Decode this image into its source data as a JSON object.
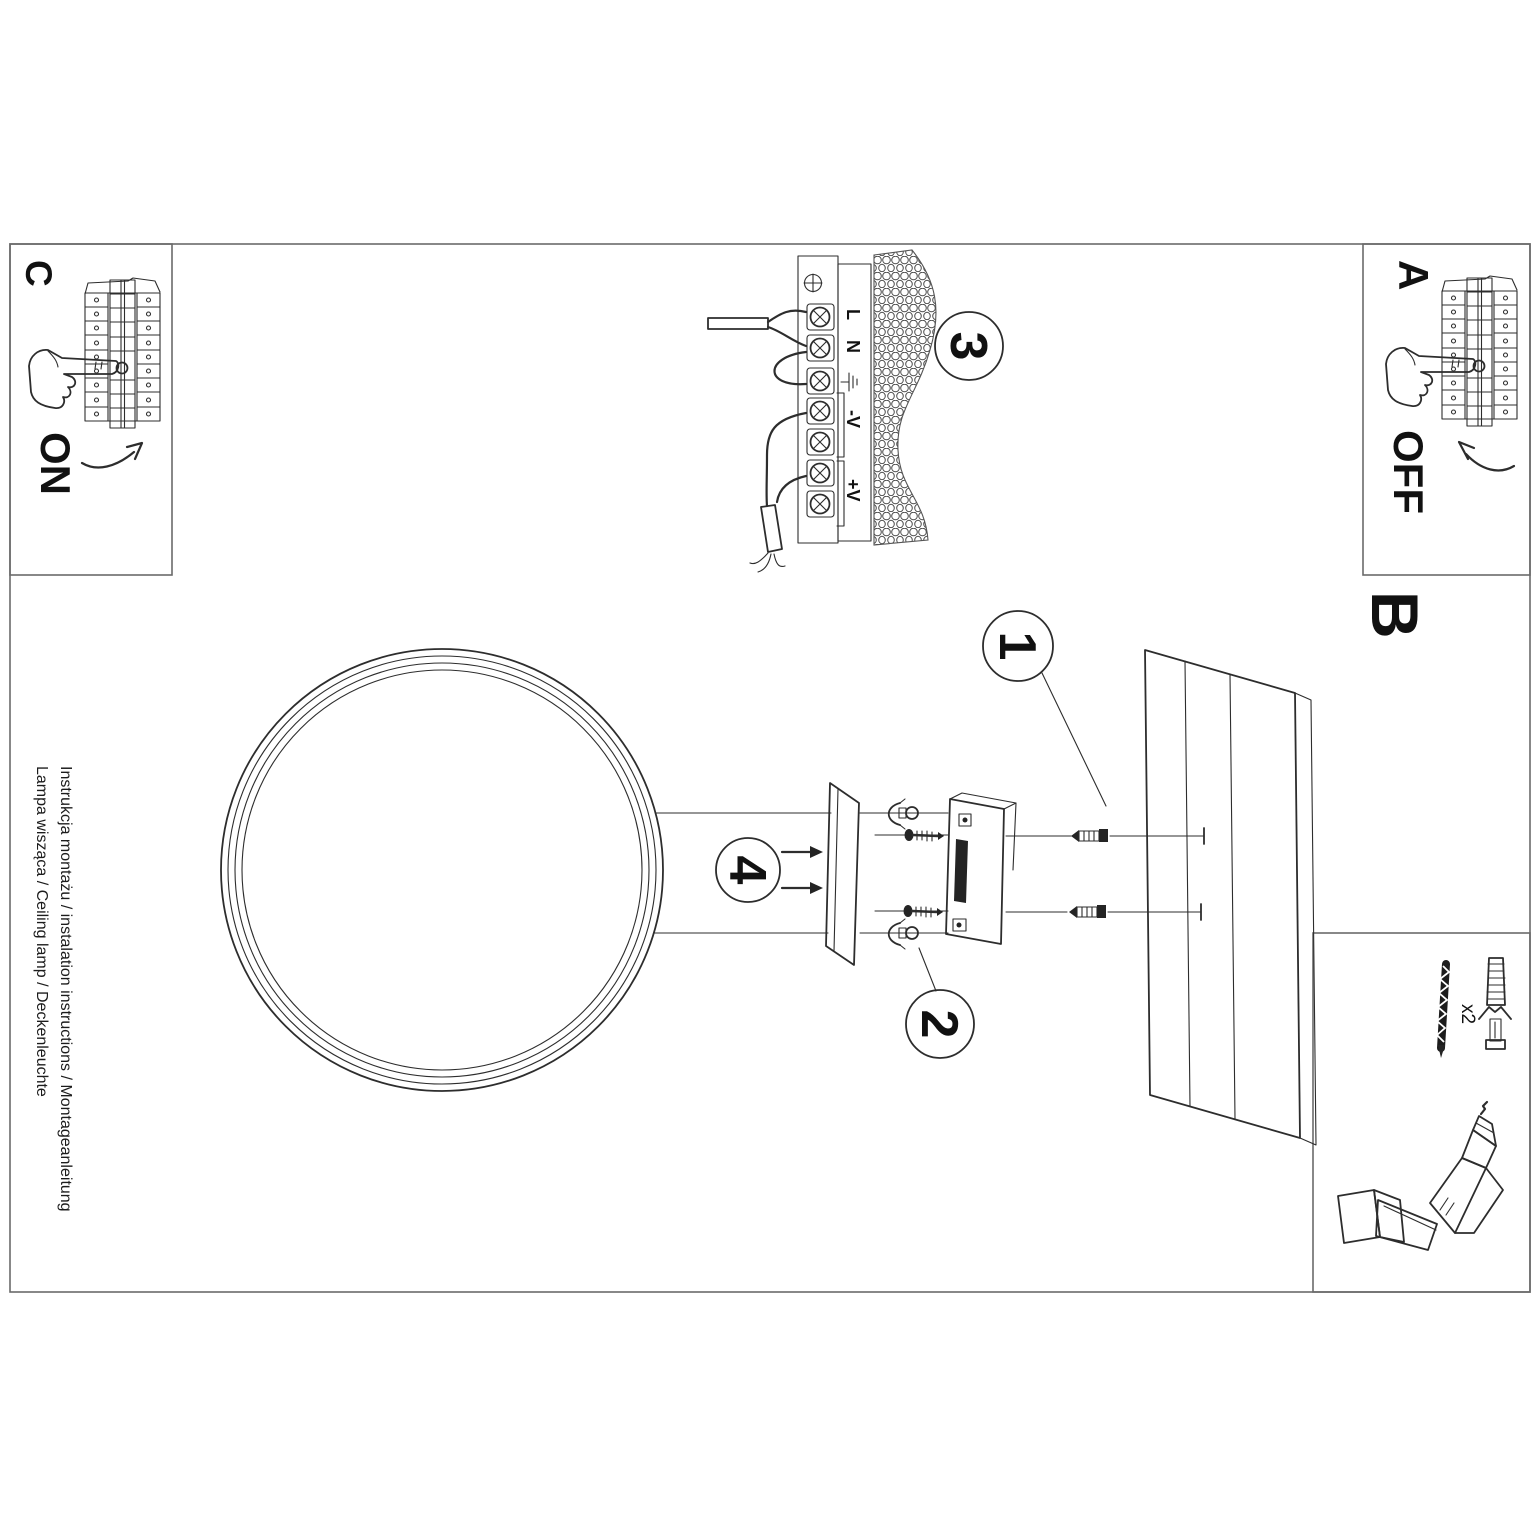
{
  "page": {
    "margin_lines": [
      "Instrukcja montażu / instalation instructions / Montageanleitung",
      "Lampa wisząca / Ceiling lamp / Deckenleuchte"
    ],
    "sections": {
      "a": {
        "label": "A",
        "switch_label": "OFF"
      },
      "b": {
        "label": "B"
      },
      "c": {
        "label": "C",
        "switch_label": "ON"
      }
    },
    "steps": [
      "1",
      "2",
      "3",
      "4"
    ],
    "terminals": {
      "live": "L",
      "neutral": "N",
      "v_minus": "-V",
      "v_plus": "+V"
    },
    "accessories": {
      "quantity": "x2"
    },
    "colors": {
      "ink": "#2d2d2d",
      "frame": "#6a6a6a",
      "paper": "#ffffff"
    }
  }
}
